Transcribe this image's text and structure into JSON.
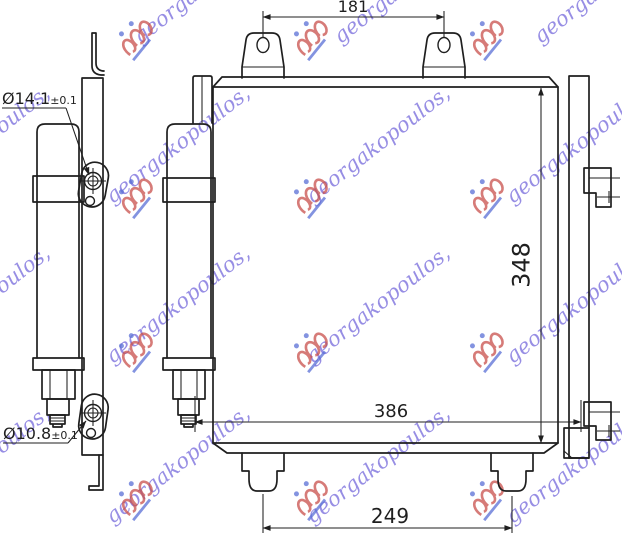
{
  "drawing": {
    "line_color": "#1f1f1f",
    "background_color": "#ffffff",
    "dimensions": {
      "top_tab_spacing": "181",
      "core_height": "348",
      "overall_width": "386",
      "bottom_tab_spacing": "249",
      "top_hole_diameter": "Ø14.1",
      "top_hole_tolerance": "±0.1",
      "bottom_hole_diameter": "Ø10.8",
      "bottom_hole_tolerance": "±0.1"
    },
    "watermark": {
      "text": "georgakopoulos,",
      "text_color": "#7b6fdd",
      "logo_color": "#c9504c",
      "accent_color": "#5a6fd6",
      "angle_deg": -38,
      "text_positions": [
        {
          "x": 10,
          "y": -10
        },
        {
          "x": 210,
          "y": -10
        },
        {
          "x": 410,
          "y": -10
        },
        {
          "x": 610,
          "y": -10
        },
        {
          "x": -18,
          "y": 150
        },
        {
          "x": 182,
          "y": 150
        },
        {
          "x": 382,
          "y": 150
        },
        {
          "x": 582,
          "y": 150
        },
        {
          "x": -18,
          "y": 310
        },
        {
          "x": 182,
          "y": 310
        },
        {
          "x": 382,
          "y": 310
        },
        {
          "x": 582,
          "y": 310
        },
        {
          "x": -18,
          "y": 470
        },
        {
          "x": 182,
          "y": 470
        },
        {
          "x": 382,
          "y": 470
        },
        {
          "x": 582,
          "y": 470
        }
      ],
      "logo_positions": [
        {
          "x": 125,
          "y": 40
        },
        {
          "x": 300,
          "y": 40
        },
        {
          "x": 476,
          "y": 40
        },
        {
          "x": 125,
          "y": 198
        },
        {
          "x": 300,
          "y": 198
        },
        {
          "x": 476,
          "y": 198
        },
        {
          "x": 125,
          "y": 352
        },
        {
          "x": 300,
          "y": 352
        },
        {
          "x": 476,
          "y": 352
        },
        {
          "x": 125,
          "y": 500
        },
        {
          "x": 300,
          "y": 500
        },
        {
          "x": 476,
          "y": 500
        }
      ]
    }
  }
}
